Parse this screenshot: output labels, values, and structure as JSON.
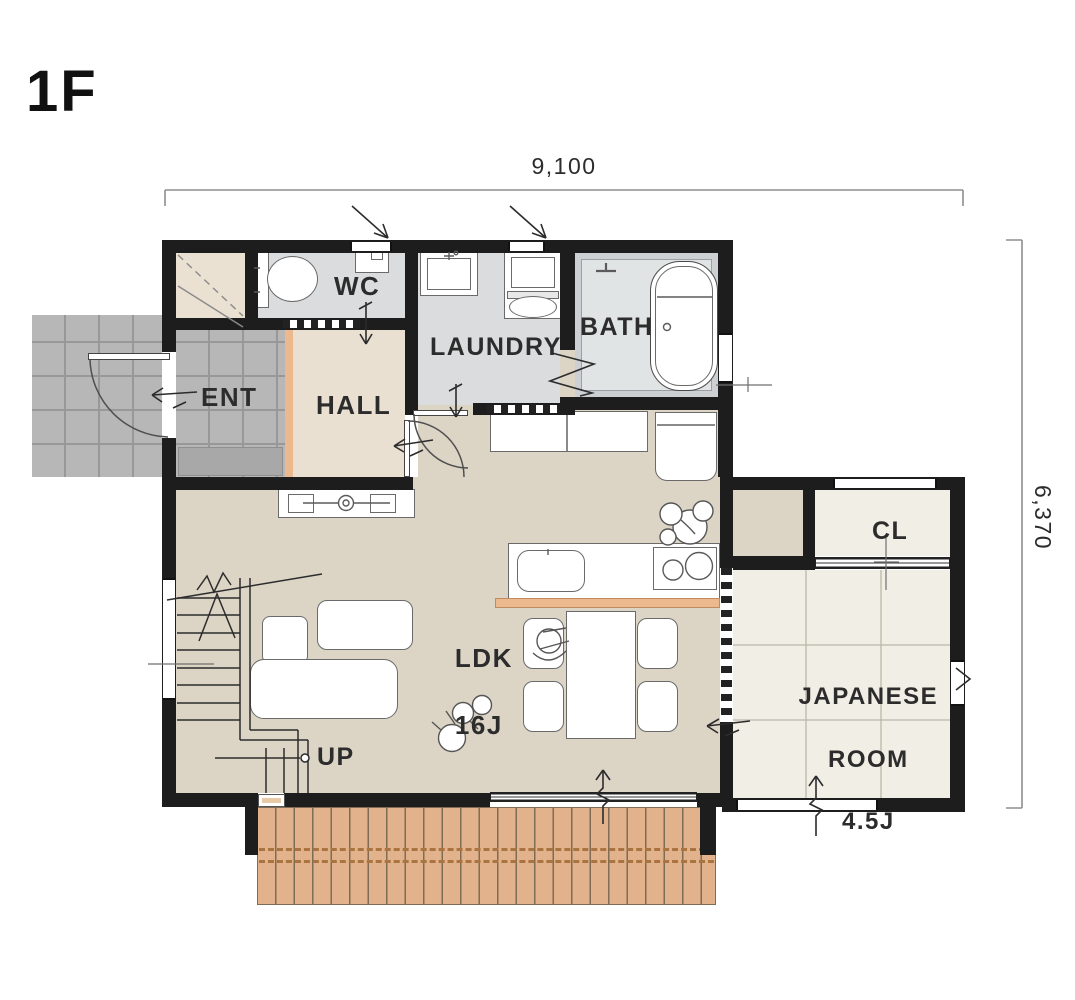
{
  "title": "1F",
  "dimensions": {
    "top": "9,100",
    "right": "6,370"
  },
  "rooms": {
    "wc": "WC",
    "laundry": "LAUNDRY",
    "bath": "BATH",
    "ent": "ENT",
    "hall": "HALL",
    "cl": "CL",
    "ldk_line1": "LDK",
    "ldk_line2": "16J",
    "japanese_line1": "JAPANESE",
    "japanese_line2": "ROOM",
    "japanese_line3": "4.5J",
    "up": "UP"
  },
  "colors": {
    "wall": "#1d1d1d",
    "floor_ldk": "#dcd5c6",
    "floor_hall": "#e9e0d1",
    "floor_wet": "#dbdcdd",
    "floor_bath": "#ccd0d2",
    "floor_tatami": "#f1eee5",
    "tile_gray": "#b7b7b7",
    "deck_wood": "#e1b28c",
    "sill_accent": "#ecb88e",
    "dimension_line": "#8d8d8d"
  }
}
